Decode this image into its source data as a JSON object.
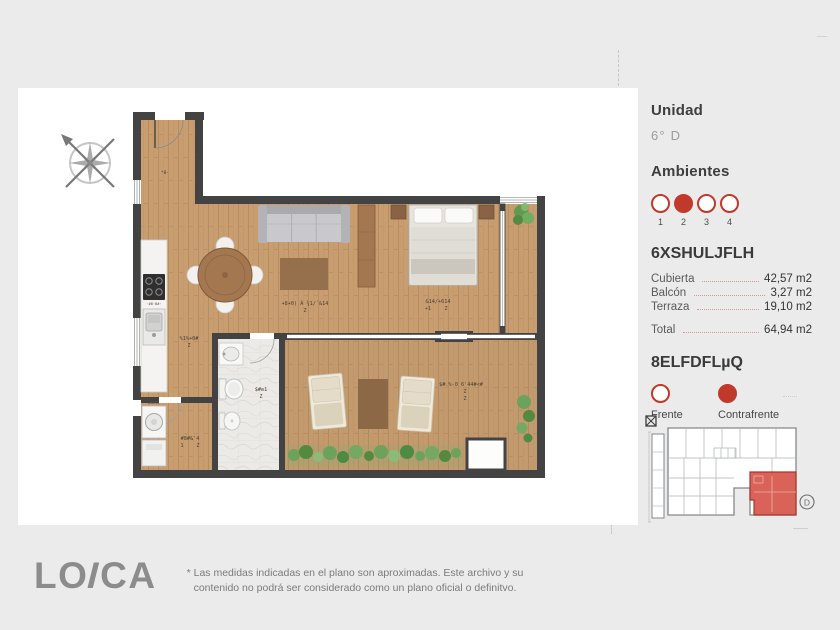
{
  "colors": {
    "accent_red": "#c0392b",
    "wall": "#434343",
    "wood": "#c89e71",
    "page_bg": "#ebebeb"
  },
  "unit_panel": {
    "unidad_label": "Unidad",
    "unidad_value": "6° D",
    "ambientes_label": "Ambientes",
    "ambientes": [
      {
        "n": "1",
        "filled": false
      },
      {
        "n": "2",
        "filled": true
      },
      {
        "n": "3",
        "filled": false
      },
      {
        "n": "4",
        "filled": false
      }
    ],
    "selected_ambiente": "2",
    "superficie_heading": "6XSHULJFLH",
    "surface_rows": [
      {
        "label": "Cubierta",
        "value": "42,57 m2"
      },
      {
        "label": "Balcón",
        "value": "3,27 m2"
      },
      {
        "label": "Terraza",
        "value": "19,10 m2"
      }
    ],
    "total_row": {
      "label": "Total",
      "value": "64,94 m2"
    },
    "ubicacion_heading": "8ELFDFLµQ",
    "orientation": [
      {
        "label": "Frente",
        "filled": false
      },
      {
        "label": "Contrafrente",
        "filled": true
      }
    ],
    "mini_plan_unit_letter": "D"
  },
  "floorplan": {
    "labels": {
      "entry": "*8·",
      "living_line1": "+8+0) Á ¾1/´&14",
      "living_line2": "Z",
      "bedroom_line1": "&14/+614",
      "bedroom_line2_left": "+1",
      "bedroom_line2_right": "Z",
      "kitchen_line1": "%1%+0#",
      "kitchen_line2": "Z",
      "bath_line1": "$#e1",
      "bath_line2": "Z",
      "laundry_line1": "#8#&'4",
      "laundry_line2_left": "1",
      "laundry_line2_right": "Z",
      "terrace_line1": "$#.%-0  6'44#<#",
      "terrace_line2": "Z",
      "terrace_line3": "Z",
      "appliance_top": "·#8·8#·",
      "appliance_bottom": "#8#44"
    }
  },
  "footer": {
    "logo_part1": "LO",
    "logo_part2": "I",
    "logo_part3": "CA",
    "disclaimer_line1": "* Las medidas indicadas en el plano son aproximadas. Este archivo y su contenido no podrá ser",
    "disclaimer_line2": "considerado como un plano oficial o definitvo."
  }
}
